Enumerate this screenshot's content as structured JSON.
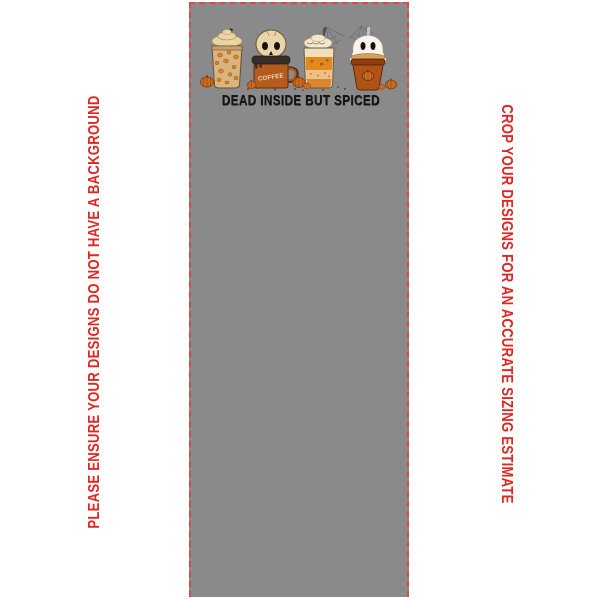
{
  "canvas": {
    "background_color": "#8a8a8a",
    "border_color": "#dd4848",
    "border_style": "dashed"
  },
  "notes": {
    "left_text": "PLEASE ENSURE YOUR DESIGNS DO NOT HAVE A BACKGROUND",
    "right_text": "CROP YOUR DESIGNS FOR AN ACCURATE SIZING ESTIMATE",
    "color": "#e32522"
  },
  "design": {
    "title": "DEAD INSIDE BUT SPICED",
    "mug_label": "COFFEE",
    "title_color": "#161616",
    "colors": {
      "frappe_cup": "#d9b47e",
      "leopard_spot": "#d8832a",
      "whipped_cream": "#e9d4a4",
      "skull_bone": "#e7d5a9",
      "mug_rust": "#b55c1c",
      "scarf_dark": "#3a2d26",
      "latte_orange": "#e08a1e",
      "glass_cream": "#efdfbc",
      "ghost_white": "#f8f4ec",
      "togo_cup": "#b05317",
      "togo_rim": "#8e3c10",
      "pumpkin_orange": "#c96a1e",
      "web_gray": "#5f6066",
      "straw_dark": "#3c3c48"
    }
  }
}
